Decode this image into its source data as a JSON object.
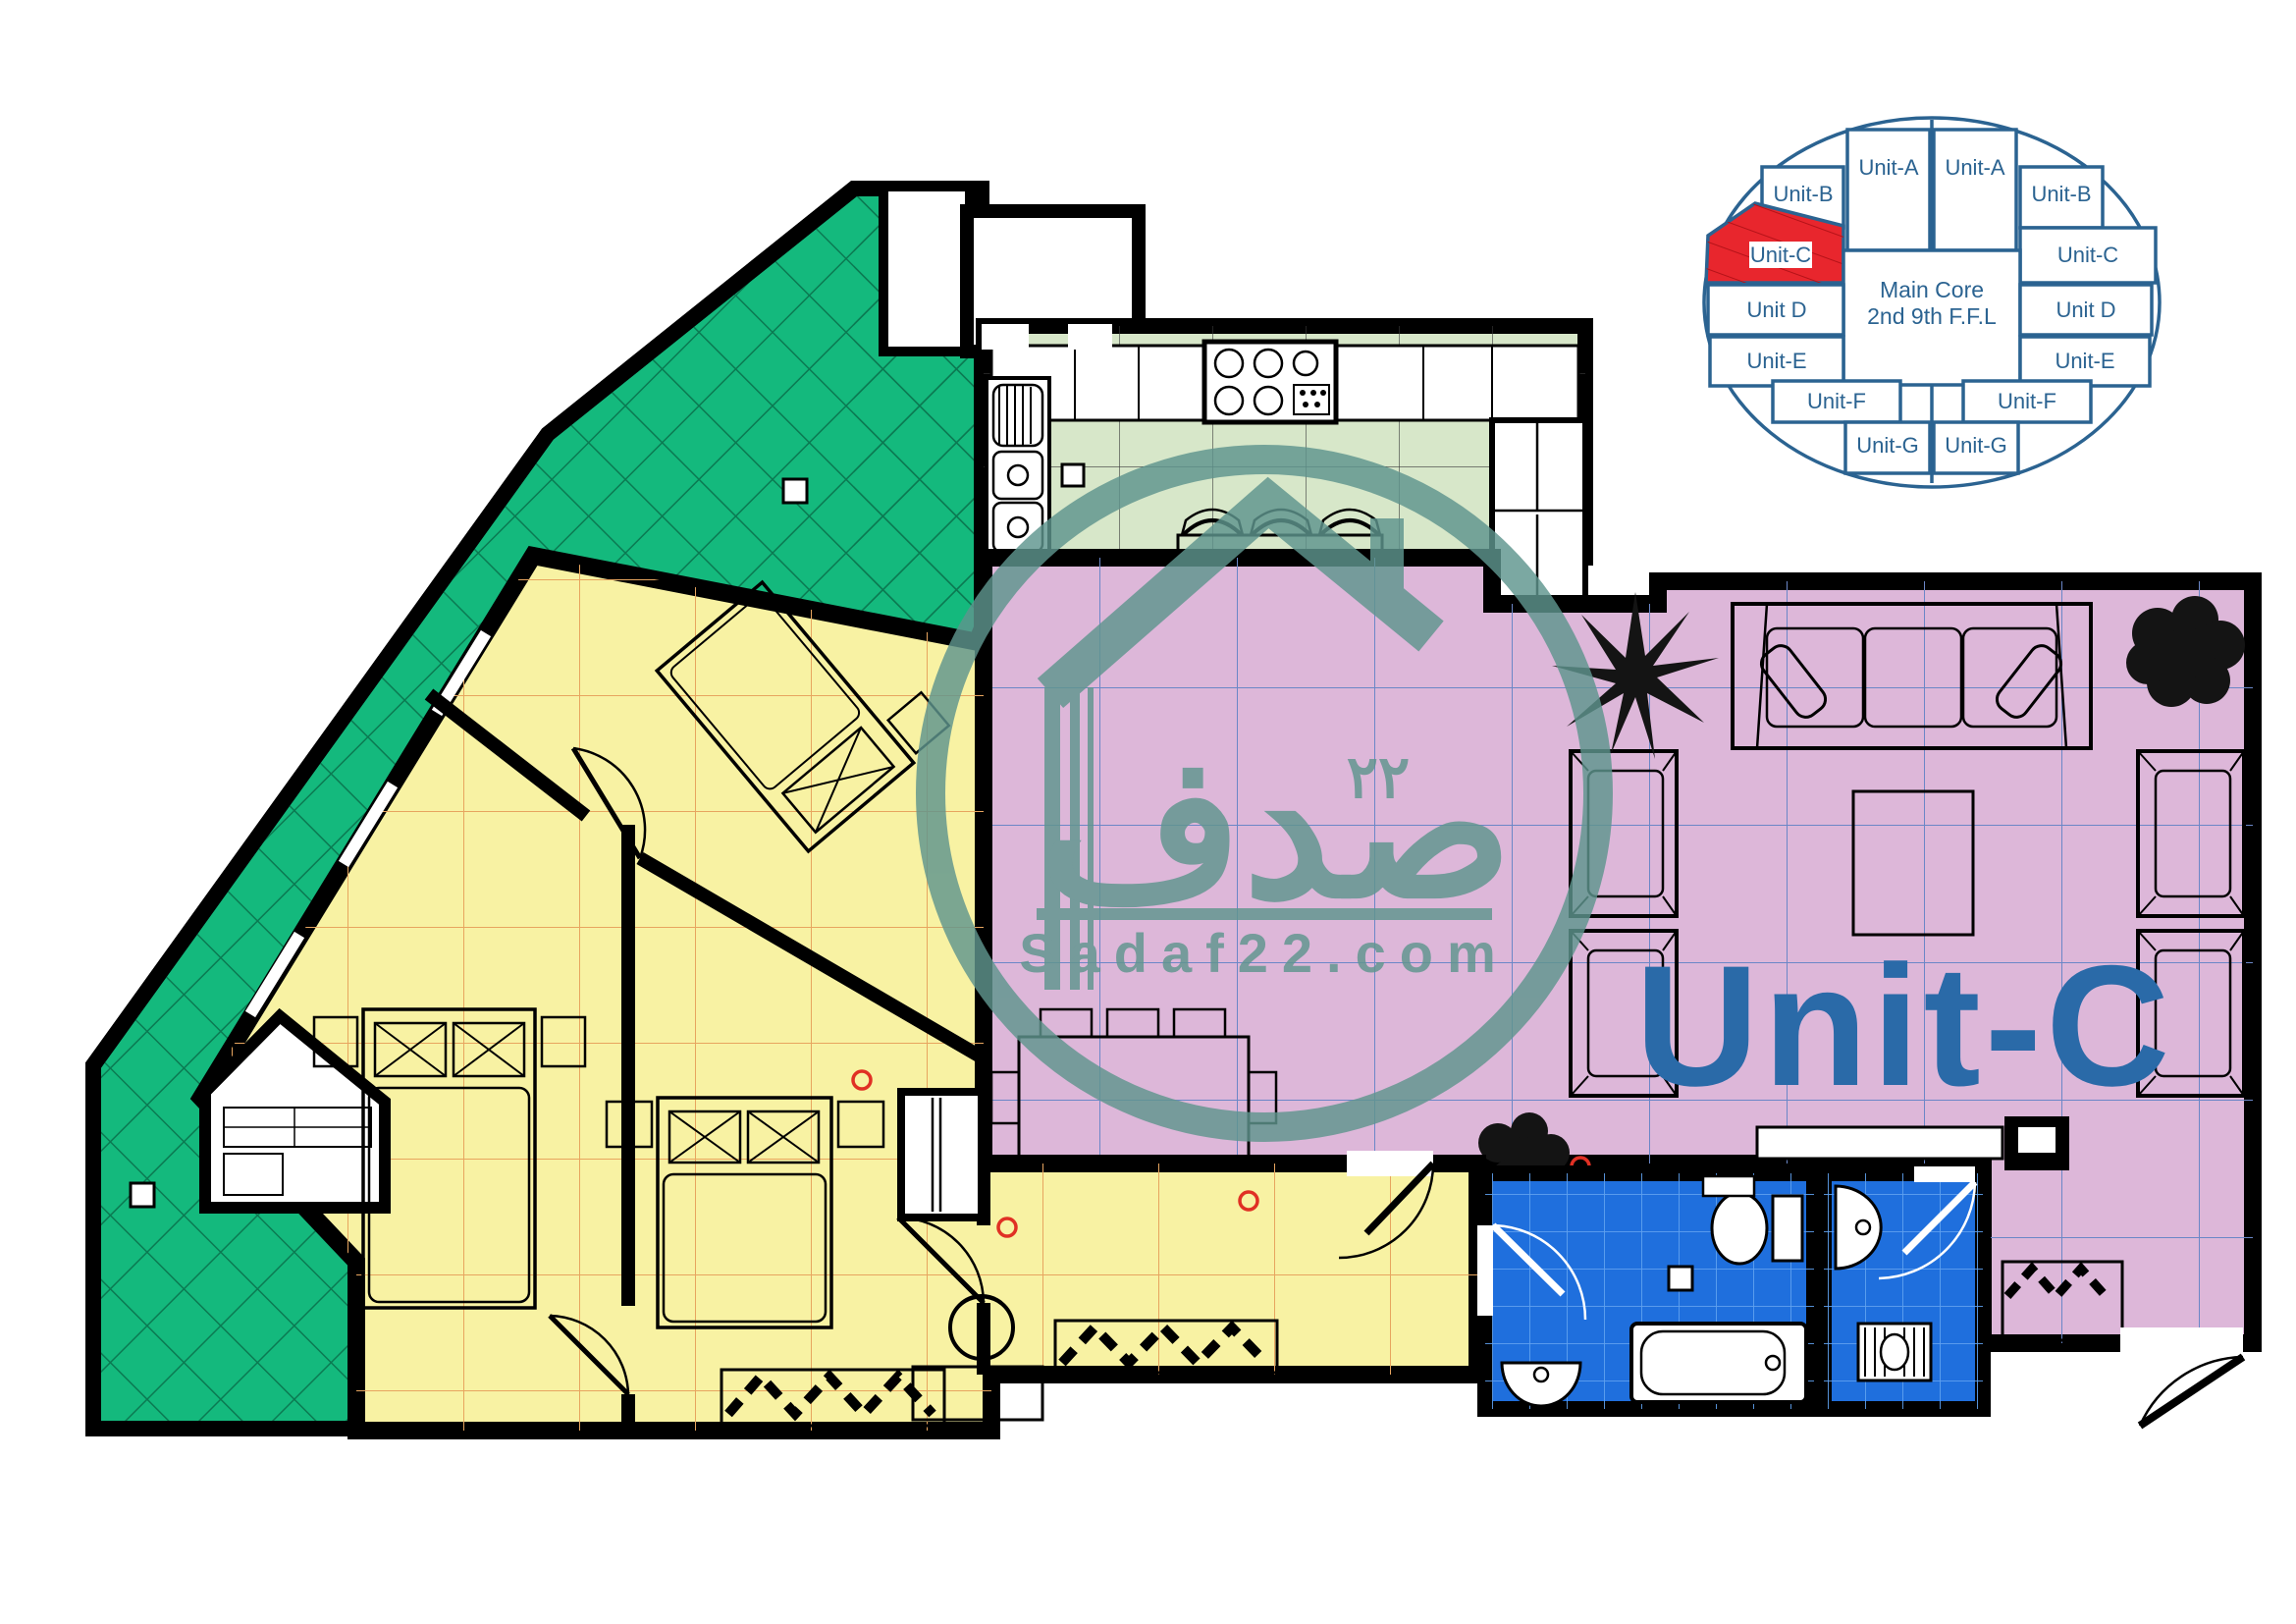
{
  "plan": {
    "unit_label": "Unit-C",
    "watermark": {
      "site": "Sadaf22.com",
      "brand_arabic": "صدف",
      "number_arabic": "٢٢"
    },
    "colors": {
      "terrace": "#14b97d",
      "terrace_grid": "#0b7a52",
      "kitchen_floor": "#d7e7c9",
      "kitchen_grid": "#3a3a3a",
      "living": "#ddb7d9",
      "living_grid": "#6b87c7",
      "bedroom": "#f8f2a3",
      "bedroom_grid": "#e7a55f",
      "bathroom": "#1f6fdd",
      "bath_grid": "#5fa1ef",
      "wall": "#000000",
      "keyplan_line": "#2b6391",
      "highlight_red": "#e8262d",
      "label_blue": "#2a6aa8",
      "watermark_teal": "#5f958e",
      "door_tag_red": "#e03024"
    }
  },
  "keyplan": {
    "core_line1": "Main Core",
    "core_line2": "2nd 9th F.F.L",
    "highlighted_unit": "Unit-C",
    "units": [
      {
        "id": "unit-a-left",
        "label": "Unit-A"
      },
      {
        "id": "unit-a-right",
        "label": "Unit-A"
      },
      {
        "id": "unit-b-left",
        "label": "Unit-B"
      },
      {
        "id": "unit-b-right",
        "label": "Unit-B"
      },
      {
        "id": "unit-c-left",
        "label": "Unit-C",
        "highlighted": true
      },
      {
        "id": "unit-c-right",
        "label": "Unit-C"
      },
      {
        "id": "unit-d-left",
        "label": "Unit D"
      },
      {
        "id": "unit-d-right",
        "label": "Unit D"
      },
      {
        "id": "unit-e-left",
        "label": "Unit-E"
      },
      {
        "id": "unit-e-right",
        "label": "Unit-E"
      },
      {
        "id": "unit-f-left",
        "label": "Unit-F"
      },
      {
        "id": "unit-f-right",
        "label": "Unit-F"
      },
      {
        "id": "unit-g-left",
        "label": "Unit-G"
      },
      {
        "id": "unit-g-right",
        "label": "Unit-G"
      }
    ]
  }
}
